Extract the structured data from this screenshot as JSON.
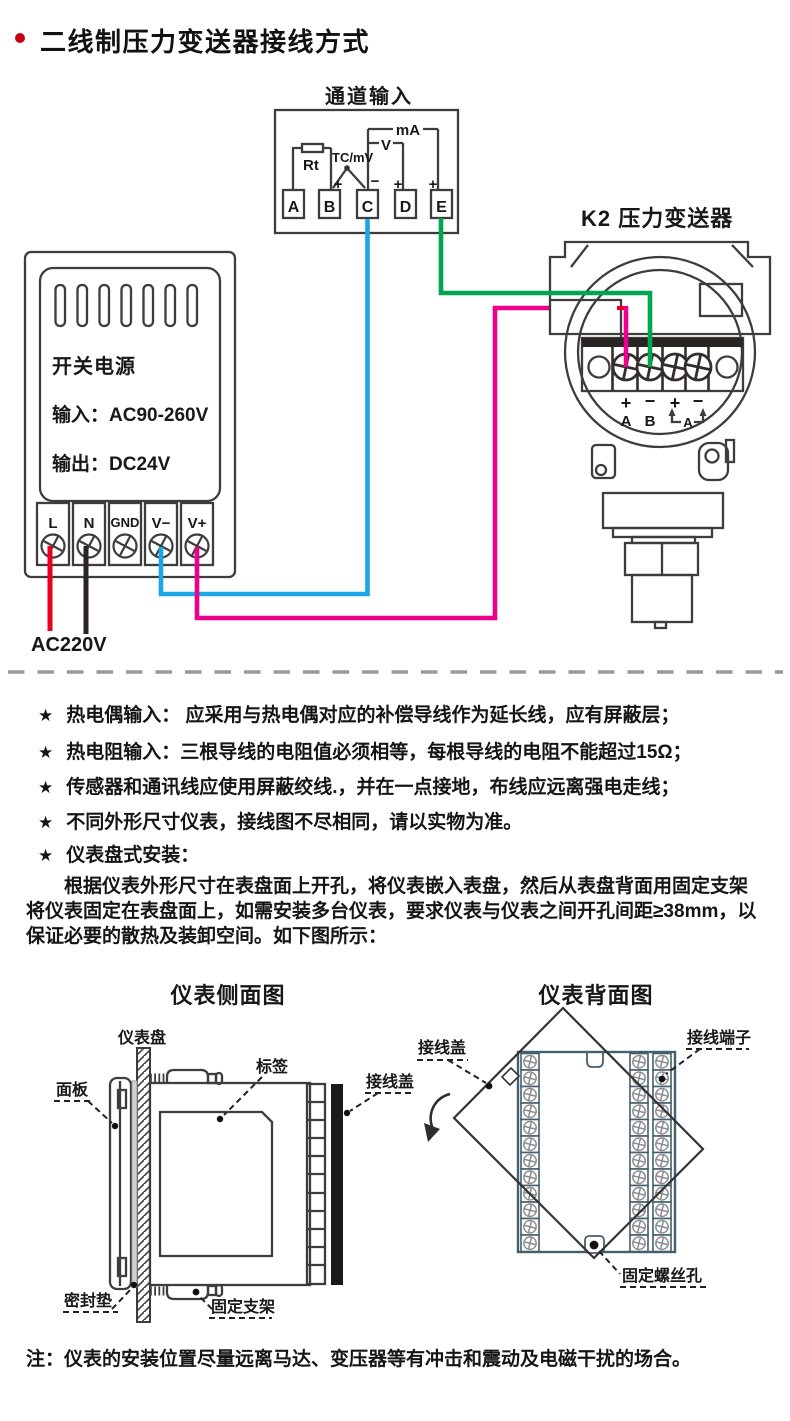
{
  "page": {
    "title": "二线制压力变送器接线方式"
  },
  "wiring": {
    "channel": {
      "title": "通道输入",
      "terminals": [
        "A",
        "B",
        "C",
        "D",
        "E"
      ],
      "rt": "Rt",
      "tc": "TC/mV",
      "v": "V",
      "ma": "mA",
      "sign_b": "+",
      "sign_c": "−",
      "sign_d": "+",
      "sign_e": "+"
    },
    "power": {
      "name": "开关电源",
      "input": "输入：AC90-260V",
      "output": "输出：DC24V",
      "terminals": [
        "L",
        "N",
        "GND",
        "V−",
        "V+"
      ],
      "mains": "AC220V"
    },
    "transmitter": {
      "title": "K2 压力变送器",
      "signs": [
        "+",
        "−",
        "+",
        "−"
      ],
      "ab": [
        "A",
        "B"
      ],
      "meter": "A"
    },
    "wire_colors": {
      "red": "#e8001f",
      "black": "#2b2422",
      "blue": "#1aa7e8",
      "magenta": "#ec008c",
      "green": "#00a650"
    }
  },
  "notes": {
    "bullet": "★",
    "items": [
      "热电偶输入： 应采用与热电偶对应的补偿导线作为延长线，应有屏蔽层；",
      "热电阻输入：三根导线的电阻值必须相等，每根导线的电阻不能超过15Ω；",
      "传感器和通讯线应使用屏蔽绞线.，并在一点接地，布线应远离强电走线；",
      "不同外形尺寸仪表，接线图不尽相同，请以实物为准。",
      "仪表盘式安装："
    ]
  },
  "install": {
    "paragraph": "根据仪表外形尺寸在表盘面上开孔，将仪表嵌入表盘，然后从表盘背面用固定支架将仪表固定在表盘面上，如需安装多台仪表，要求仪表与仪表之间开孔间距≥38mm，以保证必要的散热及装卸空间。如下图所示："
  },
  "figures": {
    "side": {
      "title": "仪表侧面图",
      "labels": {
        "panel": "仪表盘",
        "front": "面板",
        "tag": "标签",
        "cover": "接线盖",
        "seal": "密封垫",
        "bracket": "固定支架"
      }
    },
    "back": {
      "title": "仪表背面图",
      "labels": {
        "cover": "接线盖",
        "terminals": "接线端子",
        "hole": "固定螺丝孔"
      }
    }
  },
  "footer": {
    "note": "注：仪表的安装位置尽量远离马达、变压器等有冲击和震动及电磁干扰的场合。"
  }
}
